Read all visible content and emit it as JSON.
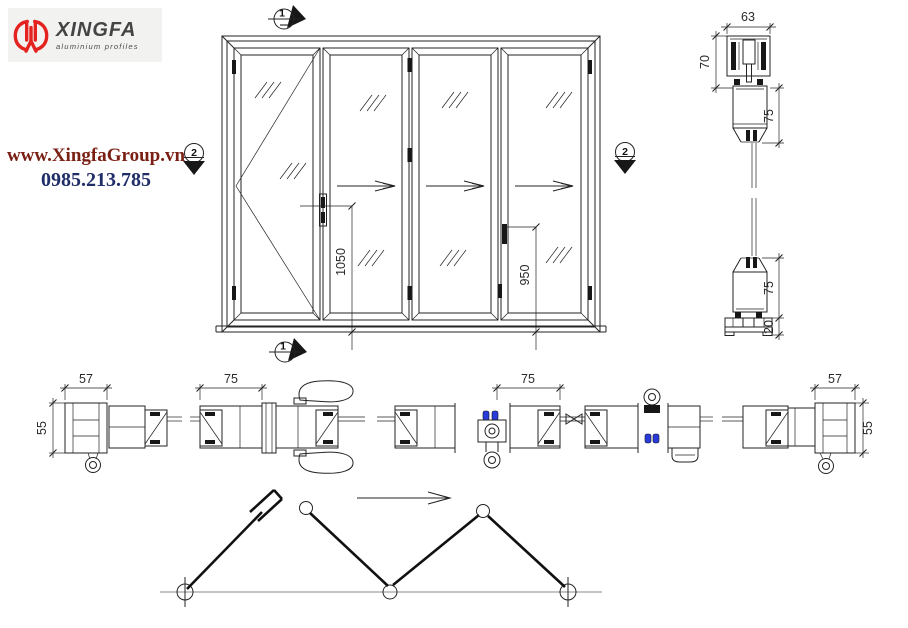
{
  "brand": {
    "name": "XINGFA",
    "tagline": "aluminium profiles",
    "website": "www.XingfaGroup.vn",
    "phone": "0985.213.785"
  },
  "colors": {
    "logo_red": "#e42320",
    "website_text": "#7a1f14",
    "phone_text": "#1f2d69",
    "line": "#232323",
    "accent_blue": "#2a3bdc"
  },
  "markers": {
    "top": "1",
    "bottom": "1",
    "left": "2",
    "right": "2"
  },
  "elevation": {
    "panel_count": "4",
    "dim_handle_left": "1050",
    "dim_handle_right": "950"
  },
  "vertical_section": {
    "dim_track_width": "63",
    "dim_track_height": "70",
    "dim_top_rail": "75",
    "dim_bottom_rail": "75",
    "dim_bottom_track": "20"
  },
  "horizontal_section": {
    "dim_left_jamb_width": "57",
    "dim_left_jamb_depth": "55",
    "dim_stile_left": "75",
    "dim_stile_mid": "75",
    "dim_right_jamb_width": "57",
    "dim_right_jamb_depth": "55"
  }
}
